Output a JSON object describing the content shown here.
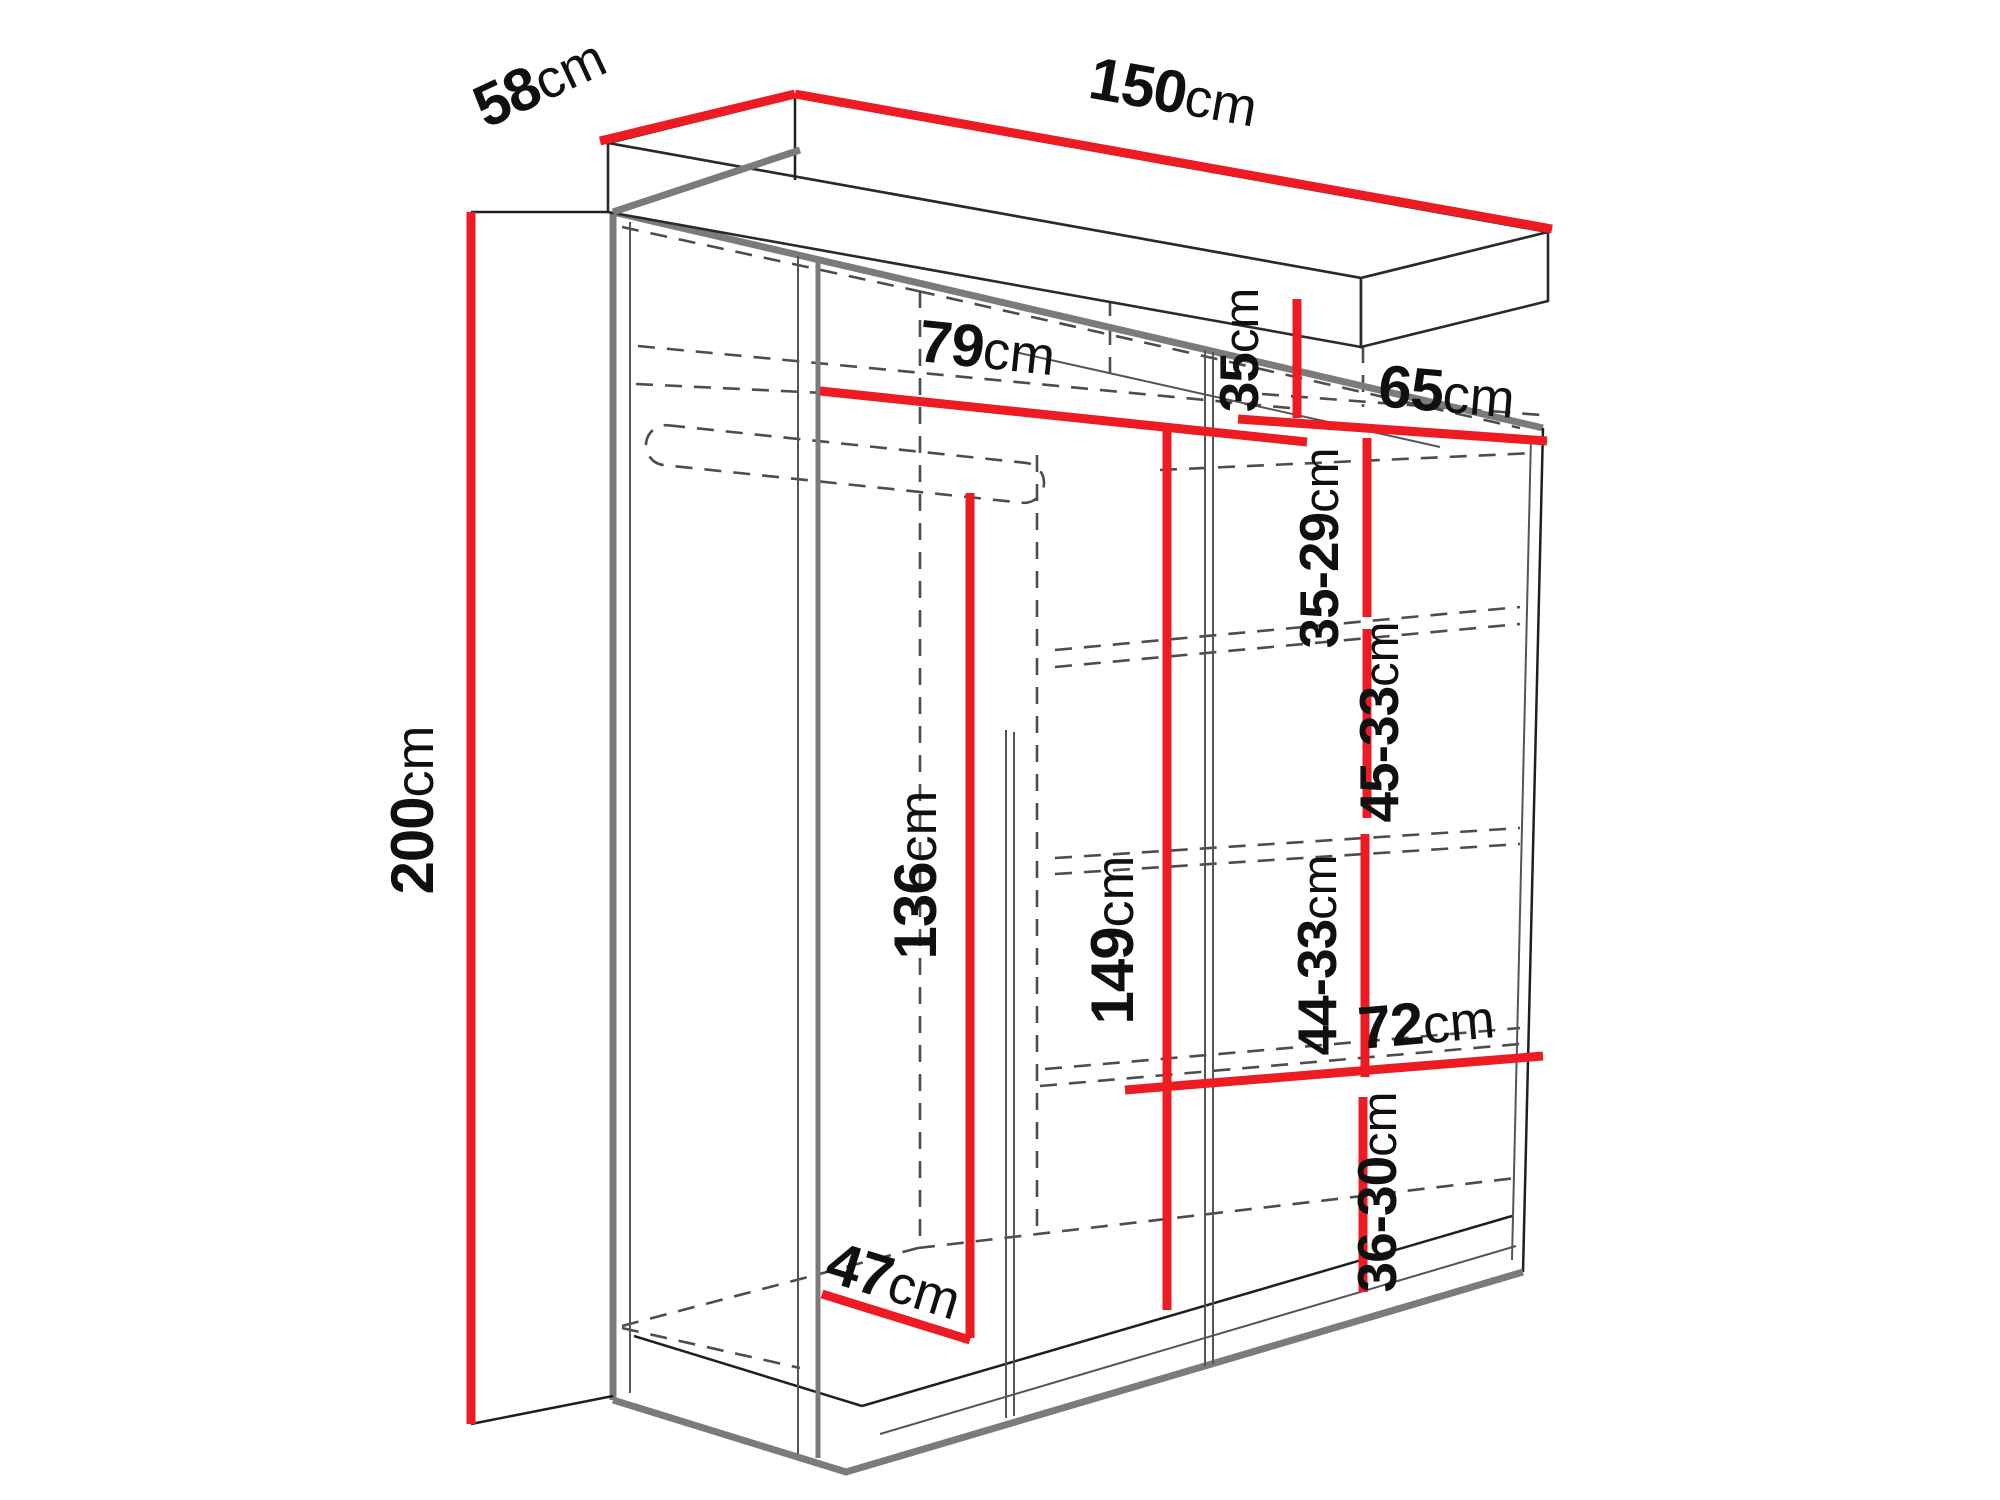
{
  "diagram": {
    "title": "Wardrobe dimension diagram",
    "unit": "cm",
    "dimensions": {
      "width": {
        "value": "150",
        "unit": "cm"
      },
      "depth": {
        "value": "58",
        "unit": "cm"
      },
      "height": {
        "value": "200",
        "unit": "cm"
      },
      "left_shelf_width": {
        "value": "79",
        "unit": "cm"
      },
      "top_shelf_drop": {
        "value": "35",
        "unit": "cm"
      },
      "right_shelf_width": {
        "value": "65",
        "unit": "cm"
      },
      "gap_top": {
        "value": "35-29",
        "unit": "cm"
      },
      "gap_upper_middle": {
        "value": "45-33",
        "unit": "cm"
      },
      "hanging_height": {
        "value": "136",
        "unit": "cm"
      },
      "right_inner_height": {
        "value": "149",
        "unit": "cm"
      },
      "gap_lower_middle": {
        "value": "44-33",
        "unit": "cm"
      },
      "bottom_shelf_width": {
        "value": "72",
        "unit": "cm"
      },
      "gap_bottom": {
        "value": "36-30",
        "unit": "cm"
      },
      "interior_depth": {
        "value": "47",
        "unit": "cm"
      }
    }
  }
}
